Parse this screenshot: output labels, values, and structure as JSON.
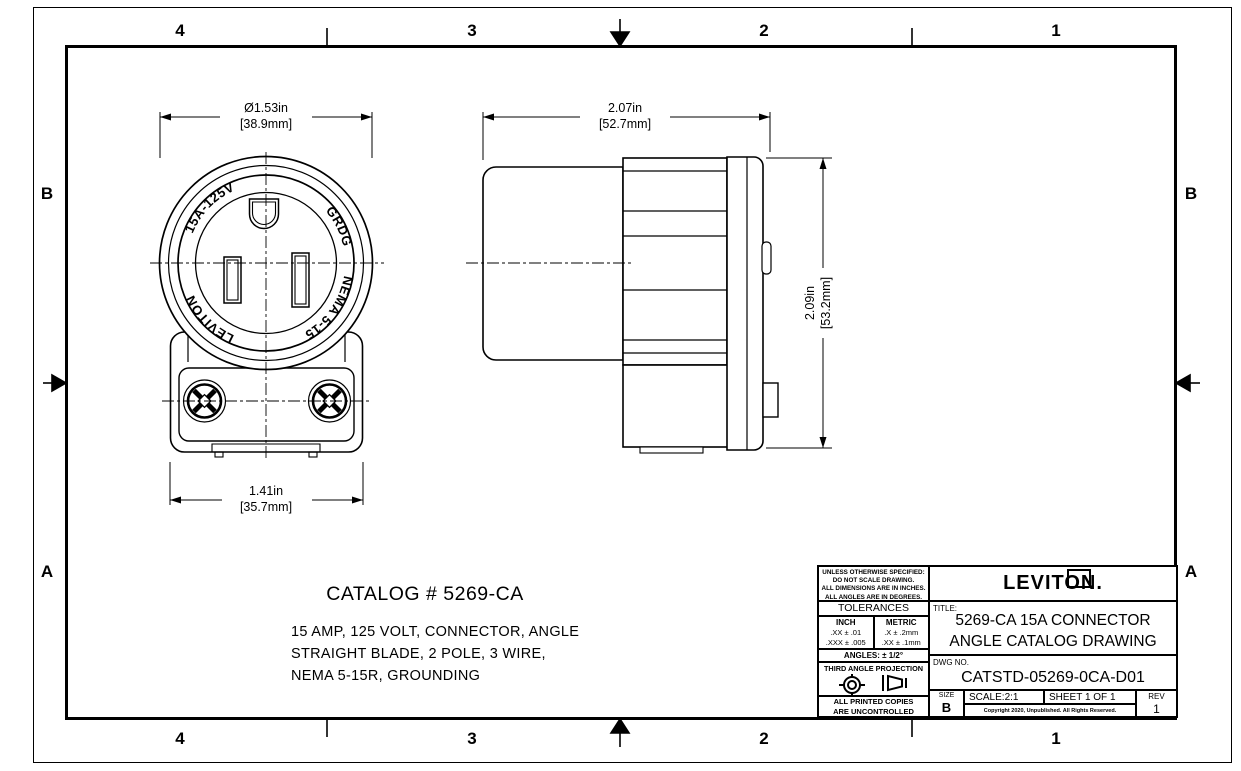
{
  "sheet": {
    "zones": {
      "columns": [
        "4",
        "3",
        "2",
        "1"
      ],
      "rows": [
        "B",
        "A"
      ]
    }
  },
  "front_view": {
    "dim_diameter_in": "Ø1.53in",
    "dim_diameter_mm": "[38.9mm]",
    "dim_width_in": "1.41in",
    "dim_width_mm": "[35.7mm]",
    "face_markings": {
      "rating": "15A-125V",
      "grounding": "GRDG",
      "brand": "LEVITON",
      "nema": "NEMA 5-15"
    }
  },
  "side_view": {
    "dim_length_in": "2.07in",
    "dim_length_mm": "[52.7mm]",
    "dim_height_in": "2.09in",
    "dim_height_mm": "[53.2mm]"
  },
  "catalog": {
    "title": "CATALOG # 5269-CA",
    "description_lines": [
      "15 AMP, 125 VOLT, CONNECTOR, ANGLE",
      "STRAIGHT BLADE, 2 POLE, 3 WIRE,",
      "NEMA 5-15R, GROUNDING"
    ]
  },
  "title_block": {
    "notes_lines": [
      "UNLESS OTHERWISE SPECIFIED:",
      "DO NOT SCALE DRAWING.",
      "ALL DIMENSIONS ARE IN INCHES.",
      "ALL ANGLES ARE IN DEGREES."
    ],
    "tolerances_header": "TOLERANCES",
    "inch_header": "INCH",
    "inch_rows": [
      ".XX ± .01",
      ".XXX ± .005"
    ],
    "metric_header": "METRIC",
    "metric_rows": [
      ".X ± .2mm",
      ".XX ± .1mm"
    ],
    "angles": "ANGLES: ± 1/2°",
    "projection_label": "THIRD ANGLE PROJECTION",
    "uncontrolled_lines": [
      "ALL PRINTED COPIES",
      "ARE UNCONTROLLED"
    ],
    "brand": "LEVITON.",
    "title_label": "TITLE:",
    "title_lines": [
      "5269-CA 15A CONNECTOR",
      "ANGLE CATALOG DRAWING"
    ],
    "dwg_label": "DWG NO.",
    "dwg_no": "CATSTD-05269-0CA-D01",
    "size_label": "SIZE",
    "size_value": "B",
    "scale": "SCALE:2:1",
    "sheet_info": "SHEET 1 OF 1",
    "copyright": "Copyright 2020, Unpublished. All Rights Reserved.",
    "rev_label": "REV",
    "rev_value": "1"
  }
}
